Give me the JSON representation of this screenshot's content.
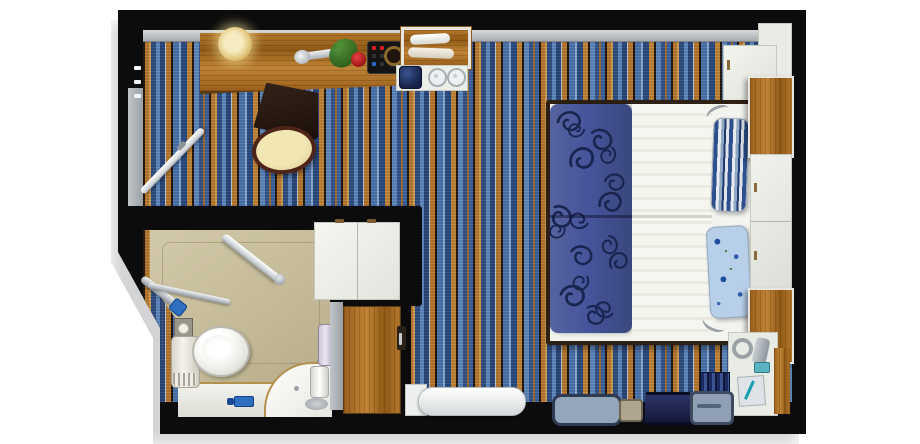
{
  "scene": {
    "kind": "floor-plan",
    "subject": "cruise-ship-cabin-top-view",
    "areas": {
      "cabin": "Stateroom",
      "bathroom": "Bathroom",
      "entry": "Entry vestibule"
    }
  },
  "palette": {
    "wall": "#0c0c0c",
    "carpet_blue": "#3a62a0",
    "carpet_orange": "#b5792f",
    "carpet_dark": "#23160c",
    "wood": "#b3782c",
    "bath_floor": "#c9bf9e",
    "bed_runner_blue": "#46549c",
    "duvet_white": "#f4f4ef",
    "cabinet_white": "#e9ebe5",
    "pillow_blue": "#b7cfe8",
    "accent_teal": "#18a0b0",
    "faucet_blue": "#2e6fc0",
    "trim_gray": "#b9bdc1"
  },
  "furniture": {
    "carpet": "Striped carpet",
    "desk": "Desk",
    "desk_lamp": "Desk lamp",
    "chair": "Desk chair",
    "phone": "Telephone",
    "rose": "Rose",
    "shoehorn": "Shoe horn",
    "clock": "Desk clock",
    "minibar_tray": "Minibar tray with bottles",
    "ice_bucket": "Ice bucket",
    "glasses": "Glasses",
    "wardrobe": "Wardrobe",
    "entry_door": "Entry door",
    "entry_handle": "Entry door handle",
    "connecting_door": "Connecting door (open)",
    "bathroom_door": "Bathroom door (open)",
    "toilet": "Toilet",
    "toilet_paper": "Toilet paper holder",
    "towel_radiator": "Towel stand",
    "shower_rail": "Shower sprayer rail",
    "grab_rail": "Grab rail",
    "sink_counter": "Sink counter",
    "basin": "Wash basin",
    "faucet": "Faucet",
    "water_heater": "Water heater",
    "shower_panel": "Shower panel",
    "bed": "Double bed",
    "bed_runner": "Patterned bed runner",
    "duvet": "Duvet",
    "pillow_striped": "Striped pillow",
    "pillow_floral": "Floral pillow",
    "reading_light": "Reading light",
    "upper_cabinet": "Upper cabinet",
    "overhead_shelf": "Overhead wood shelf",
    "bedside_cabinet": "Bedside cabinets",
    "nightstand": "Wood nightstand",
    "vanity_panel": "Vanity panel",
    "hairdryer": "Hairdryer",
    "notepad": "Notepad with pen",
    "bench": "Bench",
    "mats": "Floor mats",
    "rug": "Striped runner rug",
    "wood_floor": "Wood floor"
  }
}
